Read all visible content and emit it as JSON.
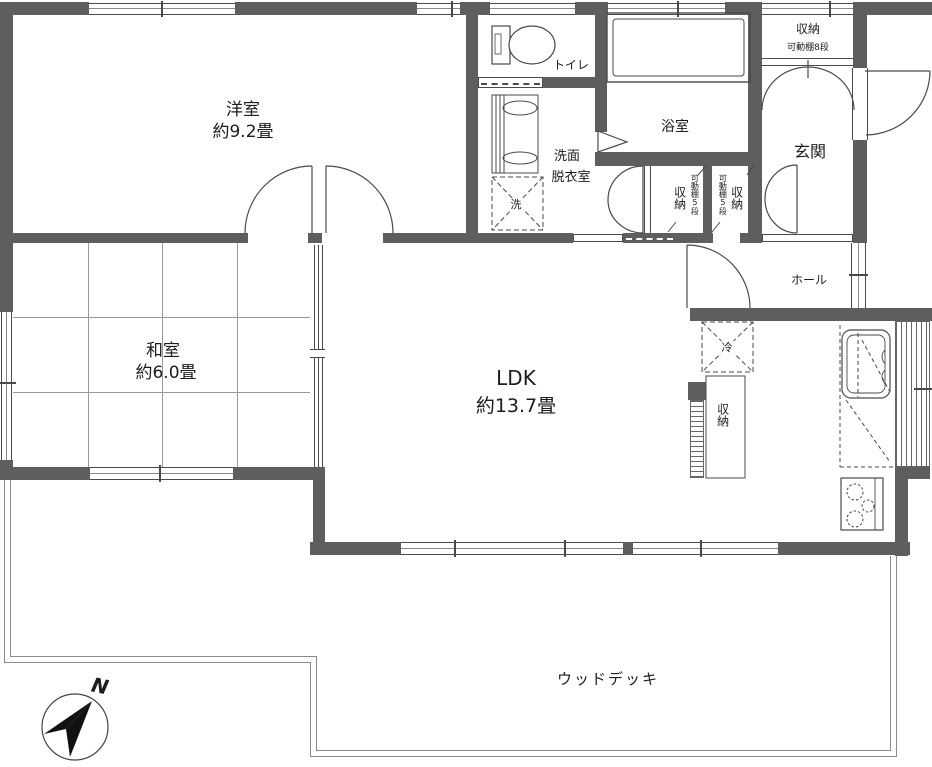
{
  "floorplan": {
    "rooms": {
      "western_room": {
        "name": "洋室",
        "size": "約9.2畳"
      },
      "japanese_room": {
        "name": "和室",
        "size": "約6.0畳"
      },
      "ldk": {
        "name": "LDK",
        "size": "約13.7畳"
      },
      "toilet": {
        "name": "トイレ"
      },
      "bathroom": {
        "name": "浴室"
      },
      "washroom": {
        "line1": "洗面",
        "line2": "脱衣室"
      },
      "entrance": {
        "name": "玄関"
      },
      "hall": {
        "name": "ホール"
      },
      "wood_deck": {
        "name": "ウッドデッキ"
      }
    },
    "storage": {
      "entry_closet": {
        "name": "収納",
        "note": "可動棚8段"
      },
      "closet_left": {
        "name": "収納",
        "note": "可動棚5段"
      },
      "closet_right": {
        "name": "収納",
        "note": "可動棚5段"
      },
      "pantry": {
        "name": "収納"
      }
    },
    "fixtures": {
      "refrigerator": "冷",
      "washing_machine": "洗"
    },
    "compass": {
      "north": "N"
    },
    "colors": {
      "wall": "#5e5e5e",
      "line": "#4a4a4a"
    }
  }
}
